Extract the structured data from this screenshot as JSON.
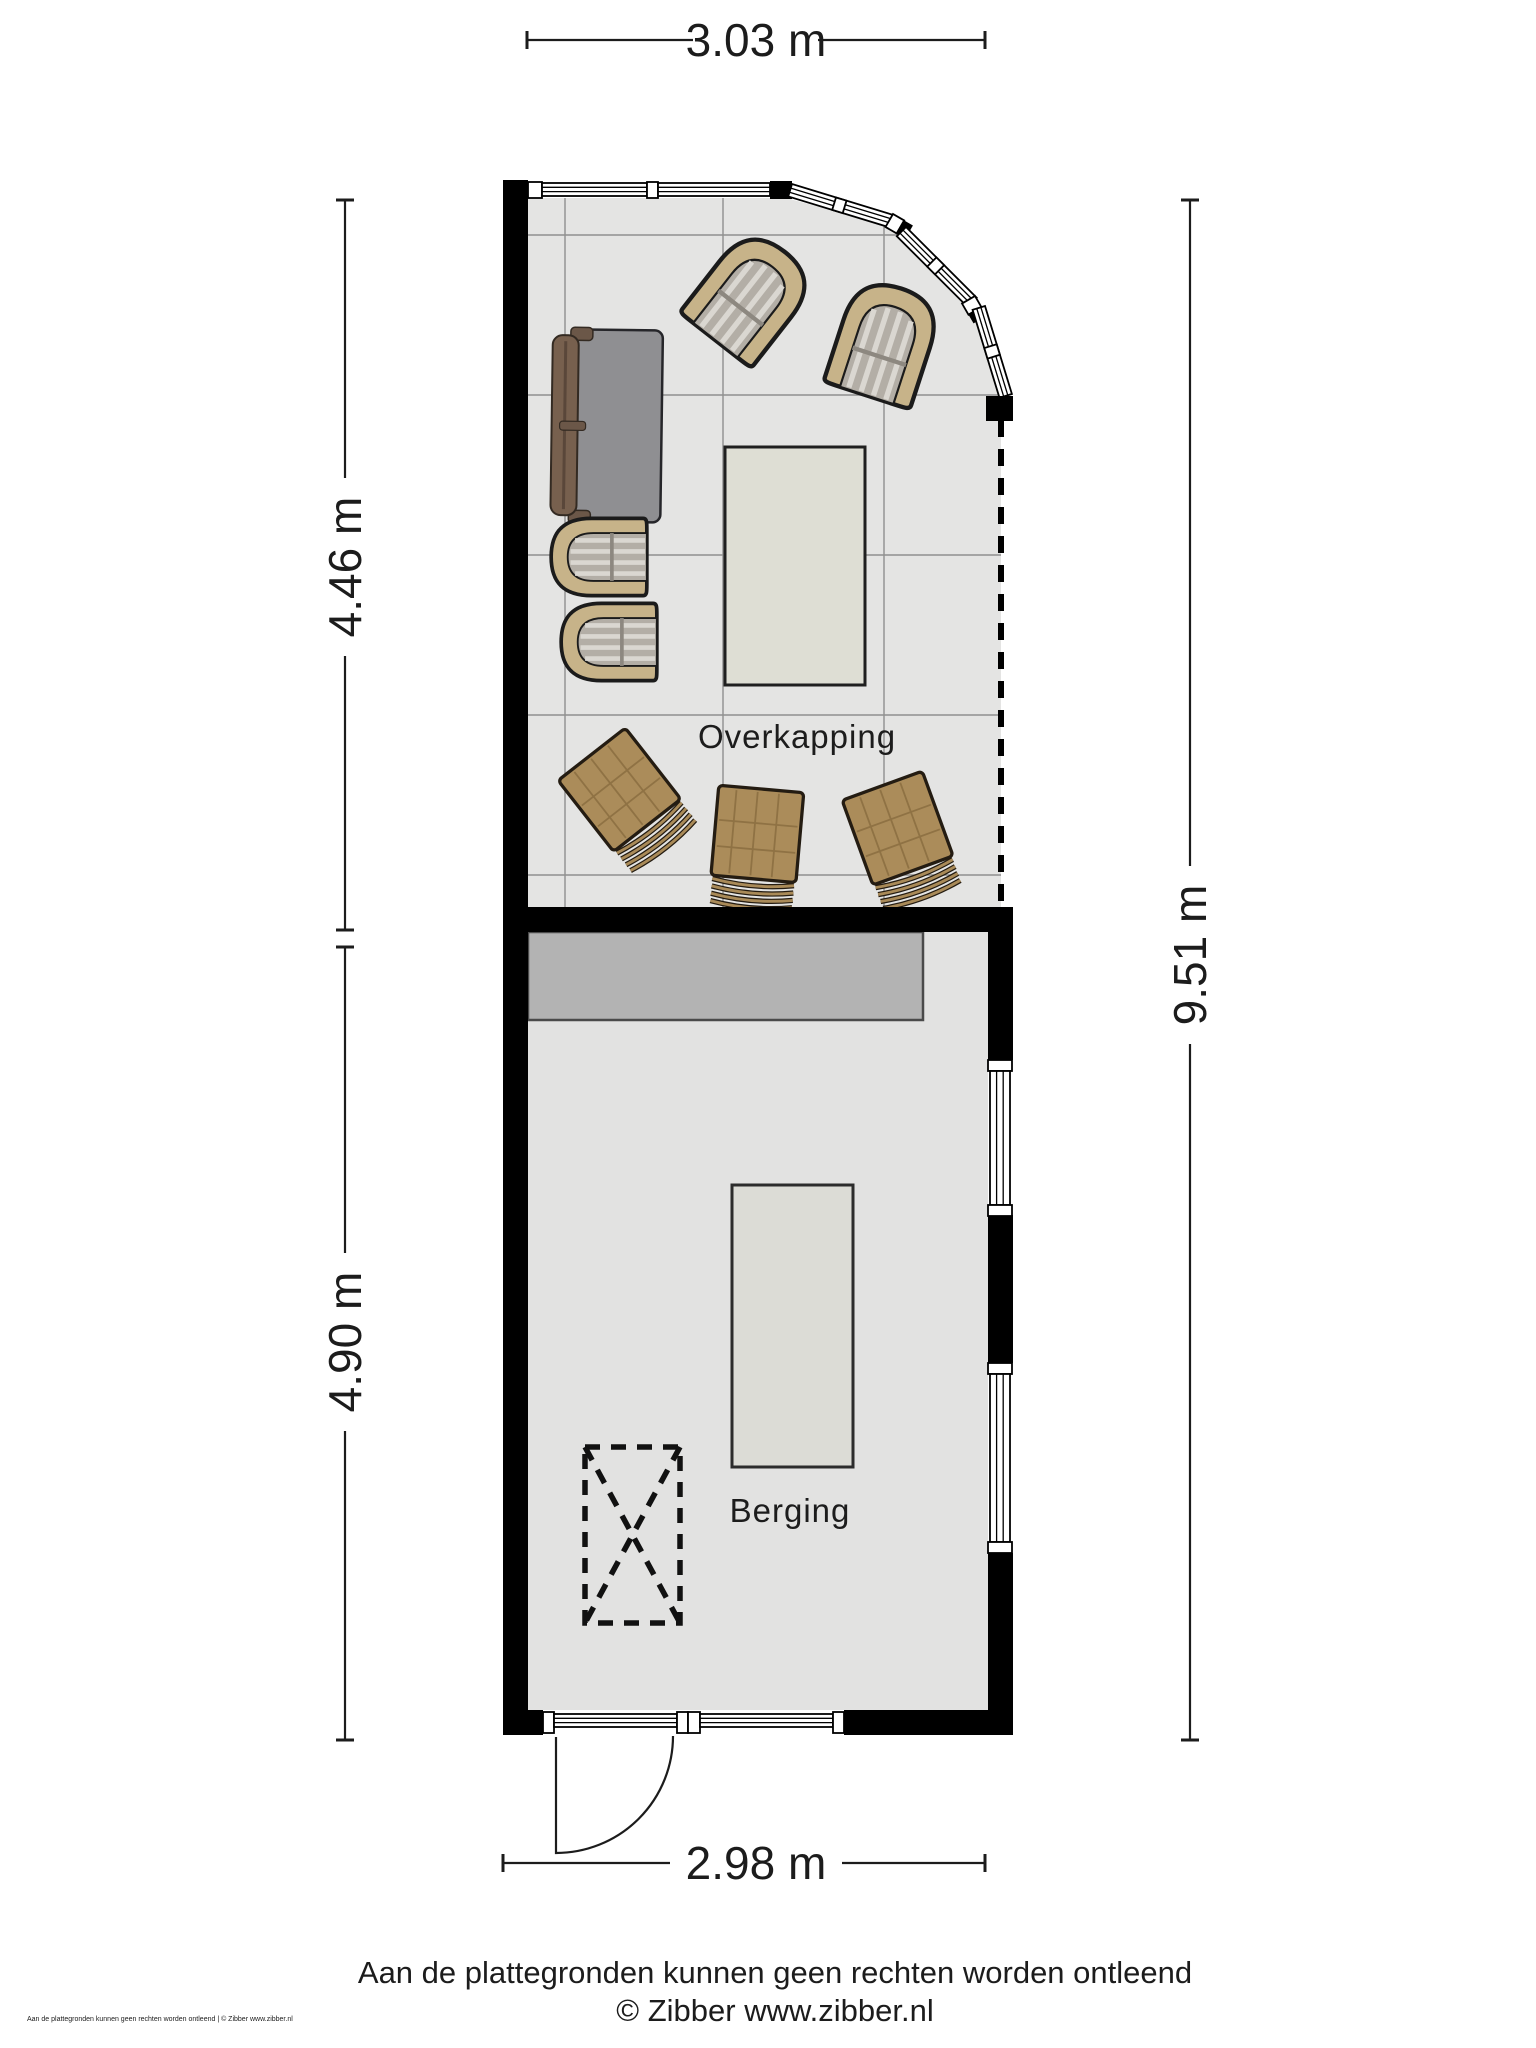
{
  "plan": {
    "rooms": [
      {
        "id": "overkapping",
        "label": "Overkapping"
      },
      {
        "id": "berging",
        "label": "Berging"
      }
    ],
    "dimensions": {
      "top": "3.03 m",
      "left_upper": "4.46 m",
      "left_lower": "4.90 m",
      "right": "9.51 m",
      "bottom": "2.98 m"
    },
    "colors": {
      "wall": "#000000",
      "floor_overkapping": "#e4e4e3",
      "floor_berging": "#e2e2e1",
      "grid_line": "#8f8f8f",
      "wicker": "#c7b389",
      "cushion_stripe_base": "#b3aea6",
      "wood_chair": "#ab8c5a",
      "sofa_frame": "#77604e",
      "sofa_cushion": "#8f8f92",
      "workbench": "#b3b3b3",
      "table_overkapping": "#deded4",
      "table_berging": "#dcdcd6"
    }
  },
  "footer": {
    "disclaimer": "Aan de plattegronden kunnen geen rechten worden ontleend",
    "credit": "© Zibber www.zibber.nl",
    "corner_note": "Aan de plattegronden kunnen geen rechten worden ontleend | © Zibber www.zibber.nl"
  }
}
